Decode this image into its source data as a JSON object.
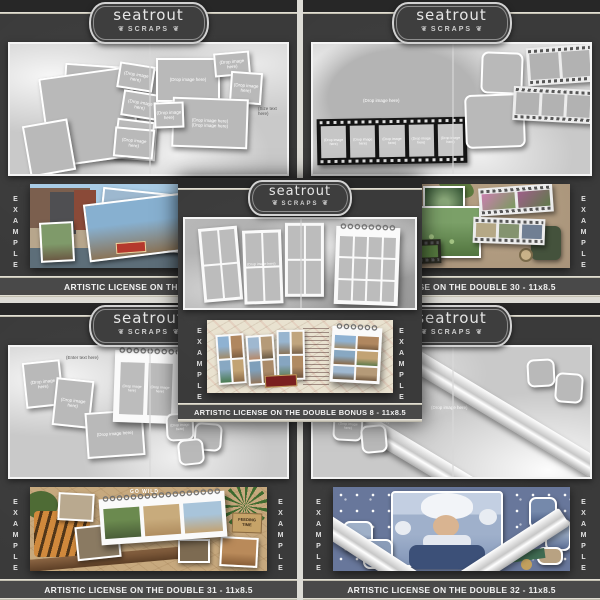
{
  "brand": {
    "name": "seatrout",
    "sub": "SCRAPS",
    "flourish": "❦"
  },
  "shared": {
    "example_label": "EXAMPLE",
    "drop_label": "(Drop image here)",
    "enter_label": "(Enter text here)",
    "size_label": "(Size text here)"
  },
  "panels": {
    "top_left": {
      "caption": "ARTISTIC LICENSE ON THE DOU"
    },
    "top_right": {
      "caption": "ARTISTIC LICENSE ON THE DOUBLE 30 - 11x8.5"
    },
    "center": {
      "caption": "ARTISTIC LICENSE ON THE DOUBLE BONUS 8 - 11x8.5"
    },
    "bottom_left": {
      "caption": "ARTISTIC LICENSE ON THE DOUBLE 31 - 11x8.5",
      "example_sign_top": "GO WILD",
      "example_sign_right": "FEEDING TIME"
    },
    "bottom_right": {
      "caption": "ARTISTIC LICENSE ON THE DOUBLE 32 - 11x8.5"
    }
  },
  "colors": {
    "panel_bg": "#3a3a3a",
    "header_band": "#272727",
    "silver_line": "#d8d4c4",
    "caption_bar": "#494949",
    "template_bg": "#c9c9c9",
    "placeholder_fill": "#b9b9b9",
    "badge_border": "#d2d2d2",
    "caption_text": "#f2f2f2"
  }
}
